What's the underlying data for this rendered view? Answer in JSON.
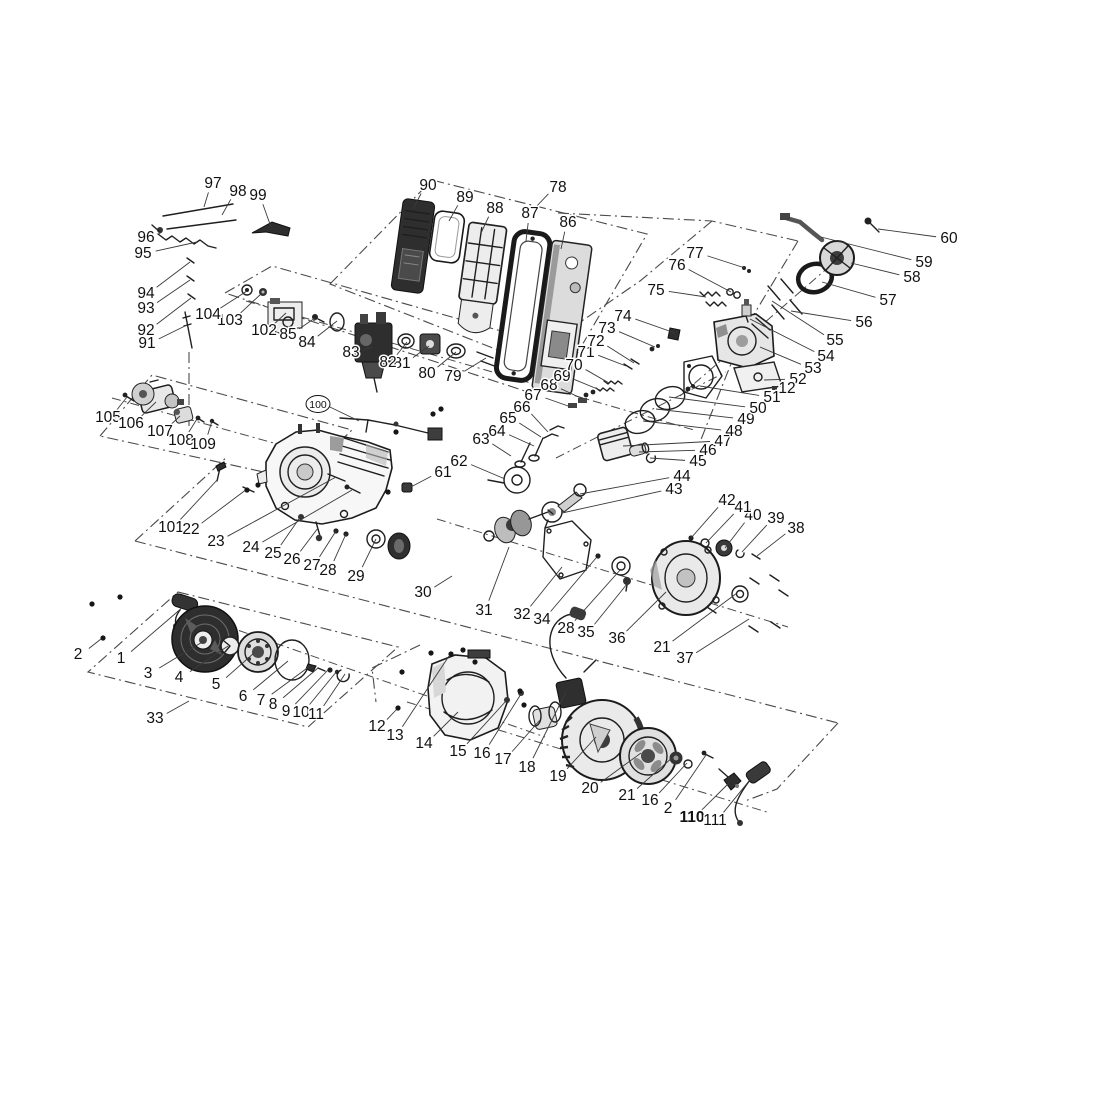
{
  "figure": {
    "kind": "exploded parts diagram - small gasoline engine",
    "background": "#ffffff",
    "line_color": "#1f1f1f",
    "boundary_color": "#4a4a4a",
    "leader_color": "#3a3a3a",
    "label_color": "#111111",
    "label_font_size": 15.5,
    "width": 1119,
    "height": 1119
  },
  "callouts": [
    {
      "n": "1",
      "x": 121,
      "y": 663,
      "tx": 183,
      "ty": 607
    },
    {
      "n": "2",
      "x": 78,
      "y": 659,
      "tx": 101,
      "ty": 639
    },
    {
      "n": "3",
      "x": 148,
      "y": 678,
      "tx": 204,
      "ty": 641
    },
    {
      "n": "4",
      "x": 179,
      "y": 682,
      "tx": 228,
      "ty": 646
    },
    {
      "n": "5",
      "x": 216,
      "y": 689,
      "tx": 254,
      "ty": 653
    },
    {
      "n": "6",
      "x": 243,
      "y": 701,
      "tx": 288,
      "ty": 661
    },
    {
      "n": "7",
      "x": 261,
      "y": 705,
      "tx": 310,
      "ty": 666
    },
    {
      "n": "8",
      "x": 273,
      "y": 709,
      "tx": 318,
      "ty": 668
    },
    {
      "n": "9",
      "x": 286,
      "y": 716,
      "tx": 328,
      "ty": 670
    },
    {
      "n": "10",
      "x": 301,
      "y": 717,
      "tx": 337,
      "ty": 671
    },
    {
      "n": "11",
      "x": 316,
      "y": 719,
      "tx": 345,
      "ty": 674
    },
    {
      "n": "33",
      "x": 155,
      "y": 723,
      "tx": 189,
      "ty": 701
    },
    {
      "n": "12",
      "x": 377,
      "y": 731,
      "tx": 397,
      "ty": 709
    },
    {
      "n": "13",
      "x": 395,
      "y": 740,
      "tx": 449,
      "ty": 656
    },
    {
      "n": "14",
      "x": 424,
      "y": 748,
      "tx": 458,
      "ty": 712
    },
    {
      "n": "15",
      "x": 458,
      "y": 756,
      "tx": 506,
      "ty": 701
    },
    {
      "n": "16",
      "x": 482,
      "y": 758,
      "tx": 521,
      "ty": 694
    },
    {
      "n": "17",
      "x": 503,
      "y": 764,
      "tx": 540,
      "ty": 720
    },
    {
      "n": "18",
      "x": 527,
      "y": 772,
      "tx": 566,
      "ty": 692
    },
    {
      "n": "19",
      "x": 558,
      "y": 781,
      "tx": 596,
      "ty": 737
    },
    {
      "n": "20",
      "x": 590,
      "y": 793,
      "tx": 641,
      "ty": 753
    },
    {
      "n": "21",
      "x": 627,
      "y": 800,
      "tx": 673,
      "ty": 757
    },
    {
      "n": "16",
      "x": 650,
      "y": 805,
      "tx": 687,
      "ty": 763
    },
    {
      "n": "2",
      "x": 668,
      "y": 813,
      "tx": 706,
      "ty": 755
    },
    {
      "n": "110",
      "x": 692,
      "y": 822,
      "tx": 729,
      "ty": 783,
      "bold": true
    },
    {
      "n": "111",
      "x": 715,
      "y": 825,
      "tx": 753,
      "ty": 776
    },
    {
      "n": "101",
      "x": 171,
      "y": 532,
      "tx": 218,
      "ty": 479
    },
    {
      "n": "22",
      "x": 191,
      "y": 534,
      "tx": 247,
      "ty": 489
    },
    {
      "n": "23",
      "x": 216,
      "y": 546,
      "tx": 336,
      "ty": 477
    },
    {
      "n": "24",
      "x": 251,
      "y": 552,
      "tx": 352,
      "ty": 490
    },
    {
      "n": "25",
      "x": 273,
      "y": 558,
      "tx": 301,
      "ty": 516
    },
    {
      "n": "26",
      "x": 292,
      "y": 564,
      "tx": 318,
      "ty": 528
    },
    {
      "n": "27",
      "x": 312,
      "y": 570,
      "tx": 336,
      "ty": 531
    },
    {
      "n": "28",
      "x": 328,
      "y": 575,
      "tx": 346,
      "ty": 534
    },
    {
      "n": "29",
      "x": 356,
      "y": 581,
      "tx": 376,
      "ty": 539
    },
    {
      "n": "30",
      "x": 423,
      "y": 597,
      "tx": 452,
      "ty": 576
    },
    {
      "n": "31",
      "x": 484,
      "y": 615,
      "tx": 509,
      "ty": 547
    },
    {
      "n": "32",
      "x": 522,
      "y": 619,
      "tx": 562,
      "ty": 567
    },
    {
      "n": "34",
      "x": 542,
      "y": 624,
      "tx": 596,
      "ty": 558
    },
    {
      "n": "28",
      "x": 566,
      "y": 633,
      "tx": 621,
      "ty": 569
    },
    {
      "n": "35",
      "x": 586,
      "y": 637,
      "tx": 627,
      "ty": 584
    },
    {
      "n": "36",
      "x": 617,
      "y": 643,
      "tx": 666,
      "ty": 592
    },
    {
      "n": "21",
      "x": 662,
      "y": 652,
      "tx": 737,
      "ty": 593
    },
    {
      "n": "37",
      "x": 685,
      "y": 663,
      "tx": 749,
      "ty": 619
    },
    {
      "n": "38",
      "x": 796,
      "y": 533,
      "tx": 757,
      "ty": 556
    },
    {
      "n": "39",
      "x": 776,
      "y": 523,
      "tx": 742,
      "ty": 552
    },
    {
      "n": "40",
      "x": 753,
      "y": 520,
      "tx": 725,
      "ty": 548
    },
    {
      "n": "41",
      "x": 743,
      "y": 512,
      "tx": 706,
      "ty": 543
    },
    {
      "n": "42",
      "x": 727,
      "y": 505,
      "tx": 691,
      "ty": 538
    },
    {
      "n": "43",
      "x": 674,
      "y": 494,
      "tx": 562,
      "ty": 513
    },
    {
      "n": "44",
      "x": 682,
      "y": 481,
      "tx": 580,
      "ty": 494
    },
    {
      "n": "45",
      "x": 698,
      "y": 466,
      "tx": 650,
      "ty": 458
    },
    {
      "n": "46",
      "x": 708,
      "y": 455,
      "tx": 639,
      "ty": 452
    },
    {
      "n": "47",
      "x": 723,
      "y": 446,
      "tx": 623,
      "ty": 446
    },
    {
      "n": "48",
      "x": 734,
      "y": 436,
      "tx": 643,
      "ty": 421
    },
    {
      "n": "49",
      "x": 746,
      "y": 424,
      "tx": 656,
      "ty": 409
    },
    {
      "n": "50",
      "x": 758,
      "y": 413,
      "tx": 669,
      "ty": 397
    },
    {
      "n": "51",
      "x": 772,
      "y": 402,
      "tx": 700,
      "ty": 386
    },
    {
      "n": "52",
      "x": 798,
      "y": 384,
      "tx": 764,
      "ty": 380
    },
    {
      "n": "12",
      "x": 787,
      "y": 393,
      "tx": 774,
      "ty": 389
    },
    {
      "n": "53",
      "x": 813,
      "y": 373,
      "tx": 760,
      "ty": 347
    },
    {
      "n": "54",
      "x": 826,
      "y": 361,
      "tx": 750,
      "ty": 319
    },
    {
      "n": "55",
      "x": 835,
      "y": 345,
      "tx": 772,
      "ty": 301
    },
    {
      "n": "56",
      "x": 864,
      "y": 327,
      "tx": 791,
      "ty": 311
    },
    {
      "n": "57",
      "x": 888,
      "y": 305,
      "tx": 822,
      "ty": 282
    },
    {
      "n": "58",
      "x": 912,
      "y": 282,
      "tx": 851,
      "ty": 263
    },
    {
      "n": "59",
      "x": 924,
      "y": 267,
      "tx": 821,
      "ty": 237
    },
    {
      "n": "60",
      "x": 949,
      "y": 243,
      "tx": 878,
      "ty": 229
    },
    {
      "n": "61",
      "x": 443,
      "y": 477,
      "tx": 409,
      "ty": 488
    },
    {
      "n": "62",
      "x": 459,
      "y": 466,
      "tx": 505,
      "ty": 479
    },
    {
      "n": "63",
      "x": 481,
      "y": 444,
      "tx": 511,
      "ty": 456
    },
    {
      "n": "64",
      "x": 497,
      "y": 436,
      "tx": 534,
      "ty": 446
    },
    {
      "n": "65",
      "x": 508,
      "y": 423,
      "tx": 541,
      "ty": 437
    },
    {
      "n": "66",
      "x": 522,
      "y": 412,
      "tx": 548,
      "ty": 432
    },
    {
      "n": "67",
      "x": 533,
      "y": 400,
      "tx": 571,
      "ty": 407
    },
    {
      "n": "68",
      "x": 549,
      "y": 390,
      "tx": 583,
      "ty": 399
    },
    {
      "n": "69",
      "x": 562,
      "y": 381,
      "tx": 600,
      "ty": 390
    },
    {
      "n": "70",
      "x": 574,
      "y": 370,
      "tx": 609,
      "ty": 383
    },
    {
      "n": "71",
      "x": 586,
      "y": 357,
      "tx": 626,
      "ty": 366
    },
    {
      "n": "72",
      "x": 596,
      "y": 346,
      "tx": 634,
      "ty": 363
    },
    {
      "n": "73",
      "x": 607,
      "y": 333,
      "tx": 655,
      "ty": 347
    },
    {
      "n": "74",
      "x": 623,
      "y": 321,
      "tx": 675,
      "ty": 333
    },
    {
      "n": "75",
      "x": 656,
      "y": 295,
      "tx": 706,
      "ty": 297
    },
    {
      "n": "76",
      "x": 677,
      "y": 270,
      "tx": 731,
      "ty": 292
    },
    {
      "n": "77",
      "x": 695,
      "y": 258,
      "tx": 745,
      "ty": 268
    },
    {
      "n": "78",
      "x": 558,
      "y": 192,
      "tx": 534,
      "ty": 209
    },
    {
      "n": "79",
      "x": 453,
      "y": 381,
      "tx": 486,
      "ty": 358
    },
    {
      "n": "80",
      "x": 427,
      "y": 378,
      "tx": 456,
      "ty": 352
    },
    {
      "n": "81",
      "x": 402,
      "y": 368,
      "tx": 429,
      "ty": 346
    },
    {
      "n": "82",
      "x": 388,
      "y": 367,
      "tx": 407,
      "ty": 342
    },
    {
      "n": "83",
      "x": 351,
      "y": 357,
      "tx": 373,
      "ty": 347
    },
    {
      "n": "84",
      "x": 307,
      "y": 347,
      "tx": 337,
      "ty": 321
    },
    {
      "n": "85",
      "x": 288,
      "y": 339,
      "tx": 315,
      "ty": 318
    },
    {
      "n": "86",
      "x": 568,
      "y": 227,
      "tx": 561,
      "ty": 249
    },
    {
      "n": "87",
      "x": 530,
      "y": 218,
      "tx": 526,
      "ty": 241
    },
    {
      "n": "88",
      "x": 495,
      "y": 213,
      "tx": 481,
      "ty": 233
    },
    {
      "n": "89",
      "x": 465,
      "y": 202,
      "tx": 449,
      "ty": 221
    },
    {
      "n": "90",
      "x": 428,
      "y": 190,
      "tx": 413,
      "ty": 209
    },
    {
      "n": "91",
      "x": 147,
      "y": 348,
      "tx": 187,
      "ty": 325
    },
    {
      "n": "92",
      "x": 146,
      "y": 335,
      "tx": 191,
      "ty": 298
    },
    {
      "n": "93",
      "x": 146,
      "y": 313,
      "tx": 190,
      "ty": 280
    },
    {
      "n": "94",
      "x": 146,
      "y": 298,
      "tx": 190,
      "ty": 262
    },
    {
      "n": "95",
      "x": 143,
      "y": 258,
      "tx": 197,
      "ty": 242
    },
    {
      "n": "96",
      "x": 146,
      "y": 242,
      "tx": 162,
      "ty": 232
    },
    {
      "n": "97",
      "x": 213,
      "y": 188,
      "tx": 204,
      "ty": 207
    },
    {
      "n": "98",
      "x": 238,
      "y": 196,
      "tx": 222,
      "ty": 215
    },
    {
      "n": "99",
      "x": 258,
      "y": 200,
      "tx": 271,
      "ty": 227
    },
    {
      "n": "100",
      "x": 318,
      "y": 408,
      "tx": 359,
      "ty": 421,
      "circled": true
    },
    {
      "n": "102",
      "x": 264,
      "y": 335,
      "tx": 286,
      "ty": 313
    },
    {
      "n": "103",
      "x": 230,
      "y": 325,
      "tx": 262,
      "ty": 293
    },
    {
      "n": "104",
      "x": 208,
      "y": 319,
      "tx": 247,
      "ty": 291
    },
    {
      "n": "105",
      "x": 108,
      "y": 422,
      "tx": 127,
      "ty": 397
    },
    {
      "n": "106",
      "x": 131,
      "y": 428,
      "tx": 156,
      "ty": 402
    },
    {
      "n": "107",
      "x": 160,
      "y": 436,
      "tx": 180,
      "ty": 416
    },
    {
      "n": "108",
      "x": 181,
      "y": 445,
      "tx": 197,
      "ty": 419
    },
    {
      "n": "109",
      "x": 203,
      "y": 449,
      "tx": 212,
      "ty": 421
    }
  ],
  "boundaries": [
    {
      "name": "air-filter-box",
      "closed": true,
      "points": [
        [
          330,
          284
        ],
        [
          432,
          180
        ],
        [
          647,
          234
        ],
        [
          564,
          376
        ]
      ]
    },
    {
      "name": "head-box-top",
      "closed": false,
      "points": [
        [
          558,
          213
        ],
        [
          712,
          221
        ],
        [
          798,
          241
        ]
      ]
    },
    {
      "name": "head-box-left",
      "closed": false,
      "points": [
        [
          712,
          221
        ],
        [
          640,
          281
        ],
        [
          560,
          336
        ]
      ]
    },
    {
      "name": "head-box-right",
      "closed": false,
      "points": [
        [
          798,
          241
        ],
        [
          744,
          331
        ],
        [
          700,
          442
        ]
      ]
    },
    {
      "name": "carburetor-box",
      "closed": true,
      "points": [
        [
          225,
          293
        ],
        [
          272,
          266
        ],
        [
          575,
          352
        ],
        [
          528,
          392
        ]
      ]
    },
    {
      "name": "starter-motor-box",
      "closed": true,
      "points": [
        [
          100,
          436
        ],
        [
          152,
          375
        ],
        [
          352,
          430
        ],
        [
          300,
          480
        ]
      ]
    },
    {
      "name": "mid-band-left-edge",
      "closed": false,
      "points": [
        [
          135,
          541
        ],
        [
          228,
          456
        ]
      ]
    },
    {
      "name": "mid-band-bottom-edge",
      "closed": false,
      "points": [
        [
          135,
          541
        ],
        [
          838,
          723
        ]
      ]
    },
    {
      "name": "bottom-band-right-edge",
      "closed": false,
      "points": [
        [
          838,
          723
        ],
        [
          777,
          789
        ],
        [
          745,
          801
        ]
      ]
    },
    {
      "name": "recoil-starter-box",
      "closed": true,
      "points": [
        [
          178,
          592
        ],
        [
          398,
          647
        ],
        [
          308,
          727
        ],
        [
          88,
          672
        ]
      ]
    },
    {
      "name": "stud-axis",
      "closed": false,
      "points": [
        [
          189,
          352
        ],
        [
          189,
          428
        ]
      ]
    },
    {
      "name": "fan-band-left-edge",
      "closed": false,
      "points": [
        [
          420,
          645
        ],
        [
          372,
          668
        ],
        [
          376,
          702
        ]
      ]
    }
  ],
  "axes": [
    {
      "name": "recoil-axis",
      "points": [
        [
          203,
          618
        ],
        [
          545,
          737
        ]
      ]
    },
    {
      "name": "flywheel-axis",
      "points": [
        [
          407,
          702
        ],
        [
          770,
          813
        ]
      ]
    },
    {
      "name": "crankshaft-axis",
      "points": [
        [
          437,
          519
        ],
        [
          788,
          627
        ]
      ]
    },
    {
      "name": "piston-axis",
      "points": [
        [
          556,
          458
        ],
        [
          726,
          372
        ]
      ]
    },
    {
      "name": "cylinder-head-axis",
      "points": [
        [
          680,
          396
        ],
        [
          846,
          252
        ]
      ]
    },
    {
      "name": "starter-motor-axis",
      "points": [
        [
          112,
          398
        ],
        [
          306,
          452
        ]
      ]
    },
    {
      "name": "carburetor-axis",
      "points": [
        [
          246,
          301
        ],
        [
          694,
          430
        ]
      ]
    }
  ],
  "dots": [
    [
      92,
      604
    ],
    [
      120,
      597
    ],
    [
      103,
      638
    ],
    [
      398,
      708
    ],
    [
      431,
      653
    ],
    [
      451,
      654
    ],
    [
      463,
      650
    ],
    [
      402,
      672
    ],
    [
      475,
      662
    ],
    [
      520,
      691
    ],
    [
      524,
      705
    ],
    [
      247,
      490
    ],
    [
      258,
      485
    ],
    [
      433,
      414
    ],
    [
      441,
      409
    ],
    [
      396,
      432
    ],
    [
      388,
      492
    ]
  ]
}
